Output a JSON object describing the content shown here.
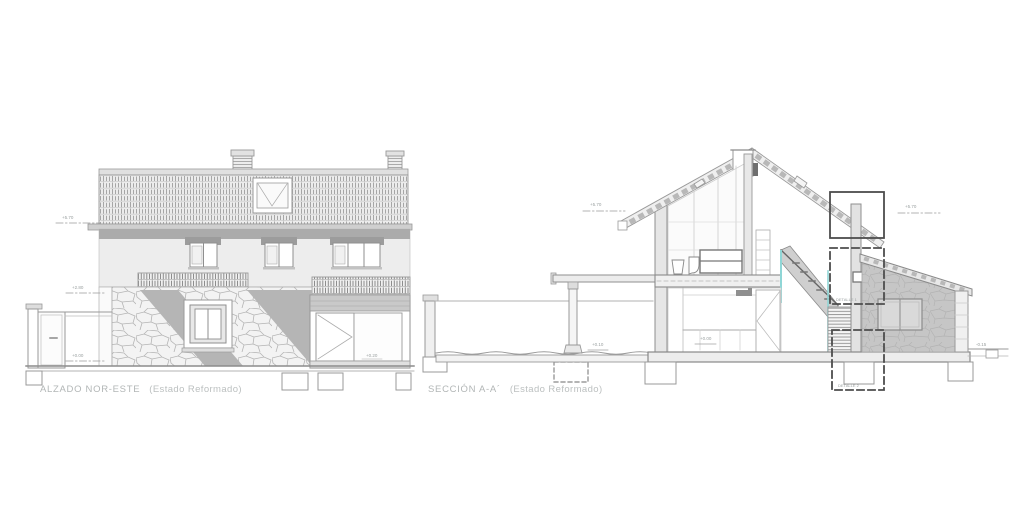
{
  "sheet": {
    "background": "#ffffff",
    "type": "architectural drawing sheet"
  },
  "elevation": {
    "caption_title": "ALZADO NOR-ESTE",
    "caption_note": "(Estado Reformado)"
  },
  "section": {
    "caption_title": "SECCIÓN A-A´",
    "caption_note": "(Estado Reformado)"
  },
  "levels": {
    "e1": "+5.70",
    "e2": "+2.80",
    "e3": "+0.00",
    "e4": "+0.20",
    "s1": "+5.70",
    "s2": "+5.70",
    "s3": "+0.10",
    "s4": "+0.00",
    "s5": "-0.15"
  },
  "details": {
    "d1": "DETALLE 1",
    "d2": "DETALLE 2"
  },
  "colors": {
    "linework": "#9c9c9c",
    "shadow": "#b5b5b5",
    "stone_fill": "#f3f3f3",
    "annex_fill": "#c6c6c6",
    "stair_glass_accent": "#8fd6d6",
    "callout_box": "#4d4d4d",
    "caption_text": "#b2b6b6"
  }
}
